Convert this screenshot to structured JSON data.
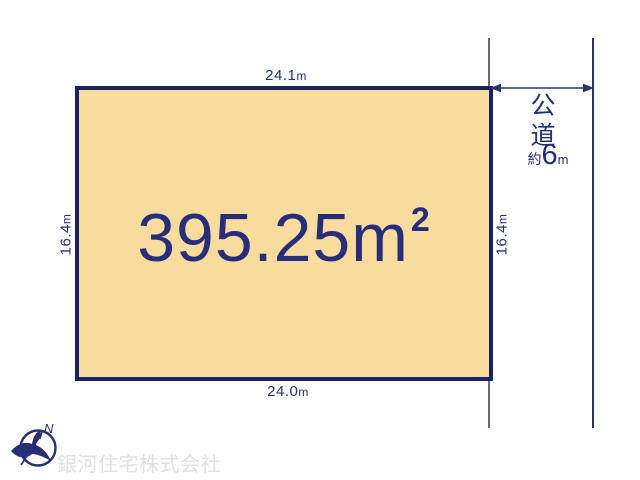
{
  "diagram": {
    "plot": {
      "area": {
        "value": "395.25",
        "unit": "m",
        "superscript": "2"
      },
      "dim_top": {
        "value": "24.1",
        "unit": "m"
      },
      "dim_bottom": {
        "value": "24.0",
        "unit": "m"
      },
      "dim_left": {
        "value": "16.4",
        "unit": "m"
      },
      "dim_right": {
        "value": "16.4",
        "unit": "m"
      }
    },
    "road": {
      "name": "公道",
      "width_prefix": "約",
      "width_value": "6",
      "width_unit": "m"
    },
    "compass": {
      "north_label": "N"
    },
    "watermark": {
      "company": "銀河住宅株式会社"
    },
    "colors": {
      "plot_fill": "#f8dc9d",
      "plot_border": "#1c2064",
      "text": "#272d78",
      "line": "#2b306f",
      "extension_line": "#62668a",
      "watermark_text": "#e2e0de"
    }
  }
}
